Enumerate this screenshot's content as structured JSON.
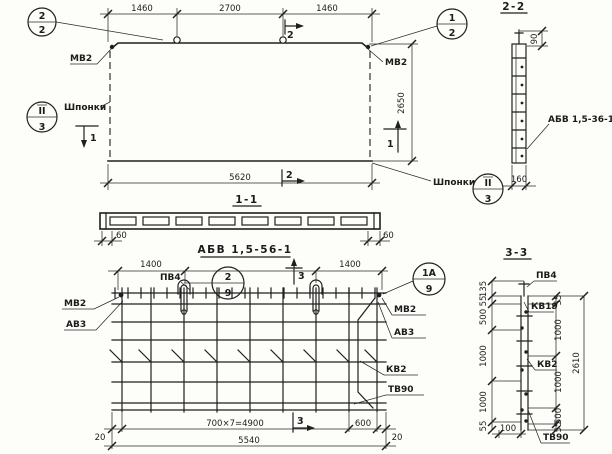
{
  "colors": {
    "ink": "#1f1f1f",
    "paper": "#fdfdfa"
  },
  "top_view": {
    "callout_left_top": "2",
    "callout_left_bottom": "2",
    "callout_right_top": "1",
    "callout_right_bottom": "2",
    "dim_left": "1460",
    "dim_mid": "2700",
    "dim_right": "1460",
    "dim_width": "5620",
    "dim_height": "2650",
    "mv2_left": "МВ2",
    "mv2_right": "МВ2",
    "shponki_left": "Шпонки",
    "shponki_right": "Шпонки",
    "node_left_top": "II",
    "node_left_bottom": "3",
    "node_right_top": "II",
    "node_right_bottom": "3",
    "cut1_left": "1",
    "cut1_right": "1",
    "cut2_top": "2",
    "cut2_bottom": "2"
  },
  "section_1_1": {
    "title": "1-1",
    "dim_left": "60",
    "dim_right": "60"
  },
  "section_2_2": {
    "title": "2-2",
    "dim_top": "90",
    "dim_width": "160",
    "mark_label": "АБВ 1,5-36-1"
  },
  "plan_view": {
    "title": "АБВ 1,5-56-1",
    "dim_left": "1400",
    "dim_right": "1400",
    "pv4": "ПВ4",
    "callout_mid_top": "2",
    "callout_mid_bottom": "9",
    "callout_right_top": "1А",
    "callout_right_bottom": "9",
    "mv2_left": "МВ2",
    "av3_left": "АВ3",
    "mv2_right": "МВ2",
    "av3_right": "АВ3",
    "kv2": "КВ2",
    "tv90": "ТВ90",
    "cut3_top": "3",
    "cut3_bottom": "3",
    "dim_20_left": "20",
    "dim_spacing": "700×7=4900",
    "dim_600": "600",
    "dim_20_right": "20",
    "dim_total": "5540"
  },
  "section_3_3": {
    "title": "3-3",
    "pv4": "ПВ4",
    "kv19": "КВ19",
    "kv2": "КВ2",
    "tv90": "ТВ90",
    "left_dims": [
      "135",
      "55",
      "500",
      "1000",
      "1000",
      "55"
    ],
    "right_dims": [
      "55",
      "1000",
      "1000",
      "500",
      "55"
    ],
    "dim_total": "2610",
    "dim_100": "100"
  }
}
